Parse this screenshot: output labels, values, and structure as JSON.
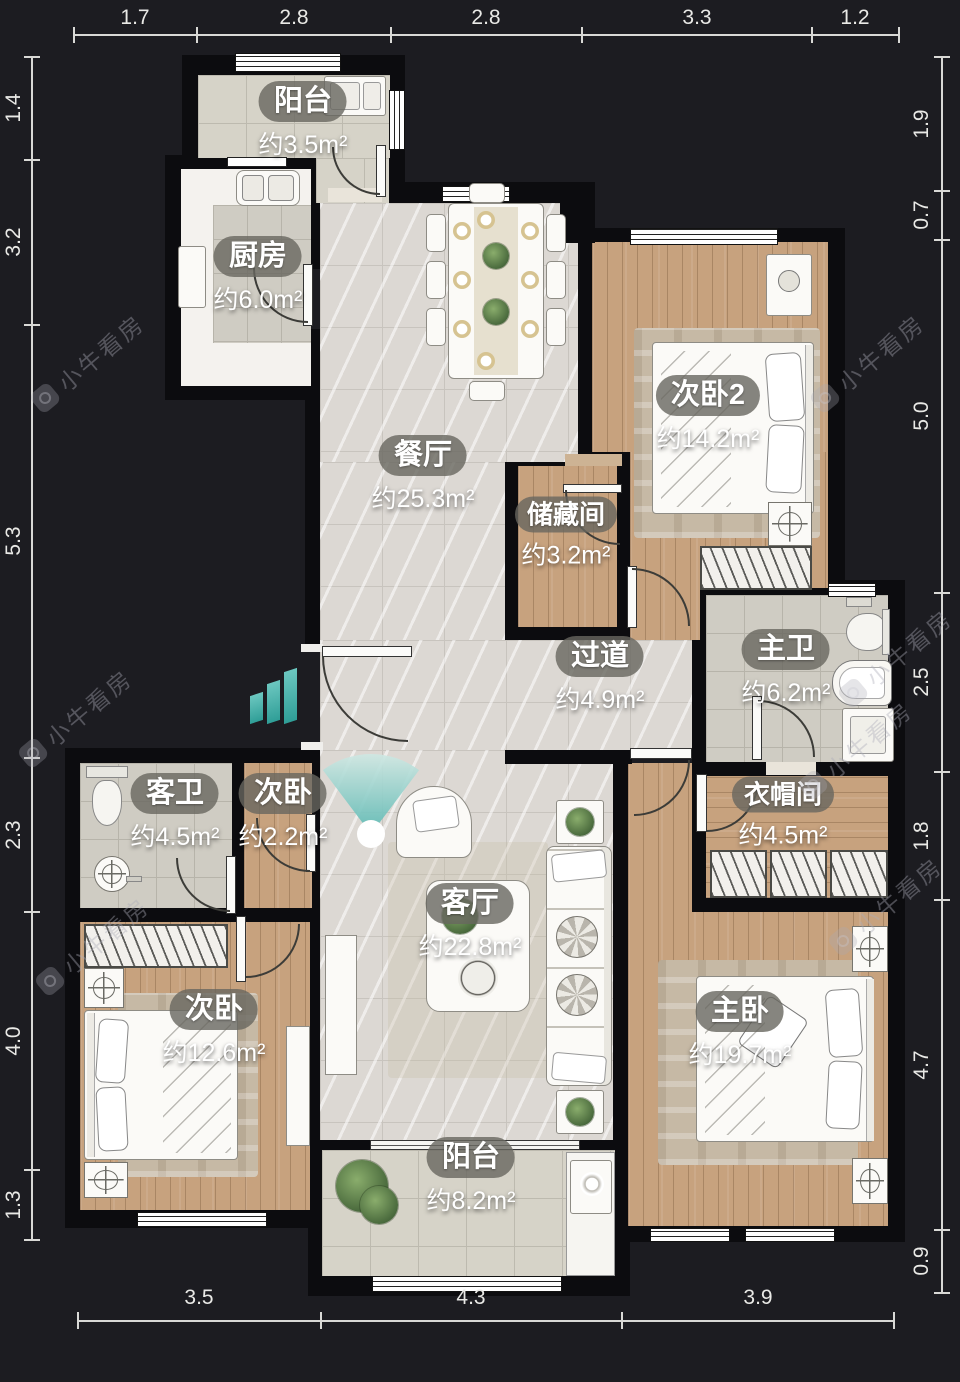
{
  "watermark": {
    "text": "小牛看房"
  },
  "rooms": [
    {
      "id": "balcony-top",
      "name": "阳台",
      "area": "约3.5m²"
    },
    {
      "id": "kitchen",
      "name": "厨房",
      "area": "约6.0m²"
    },
    {
      "id": "dining",
      "name": "餐厅",
      "area": "约25.3m²"
    },
    {
      "id": "bedroom-2",
      "name": "次卧2",
      "area": "约14.2m²"
    },
    {
      "id": "storage",
      "name": "储藏间",
      "area": "约3.2m²"
    },
    {
      "id": "hallway",
      "name": "过道",
      "area": "约4.9m²"
    },
    {
      "id": "master-bath",
      "name": "主卫",
      "area": "约6.2m²"
    },
    {
      "id": "cloakroom",
      "name": "衣帽间",
      "area": "约4.5m²"
    },
    {
      "id": "guest-bath",
      "name": "客卫",
      "area": "约4.5m²"
    },
    {
      "id": "bedroom-small",
      "name": "次卧",
      "area": "约2.2m²"
    },
    {
      "id": "living",
      "name": "客厅",
      "area": "约22.8m²"
    },
    {
      "id": "bedroom",
      "name": "次卧",
      "area": "约12.6m²"
    },
    {
      "id": "master",
      "name": "主卧",
      "area": "约19.7m²"
    },
    {
      "id": "balcony-bottom",
      "name": "阳台",
      "area": "约8.2m²"
    }
  ],
  "dimensions": {
    "top": [
      "1.7",
      "2.8",
      "2.8",
      "3.3",
      "1.2"
    ],
    "bottom": [
      "3.5",
      "4.3",
      "3.9"
    ],
    "left": [
      "1.4",
      "3.2",
      "5.3",
      "2.3",
      "4.0",
      "1.3"
    ],
    "right": [
      "1.9",
      "0.7",
      "5.0",
      "2.5",
      "1.8",
      "4.7",
      "0.9"
    ]
  },
  "colors": {
    "background": "#1c1c21",
    "wall": "#0c0c0f",
    "marble_floor": "#dcd8d3",
    "wood_floor": "#c7a27e",
    "tile_floor": "#cfccc3",
    "label_pill": "rgba(104,102,95,0.8)",
    "accent_teal": "#57b8b2",
    "dimension_text": "#e9e9e6"
  }
}
